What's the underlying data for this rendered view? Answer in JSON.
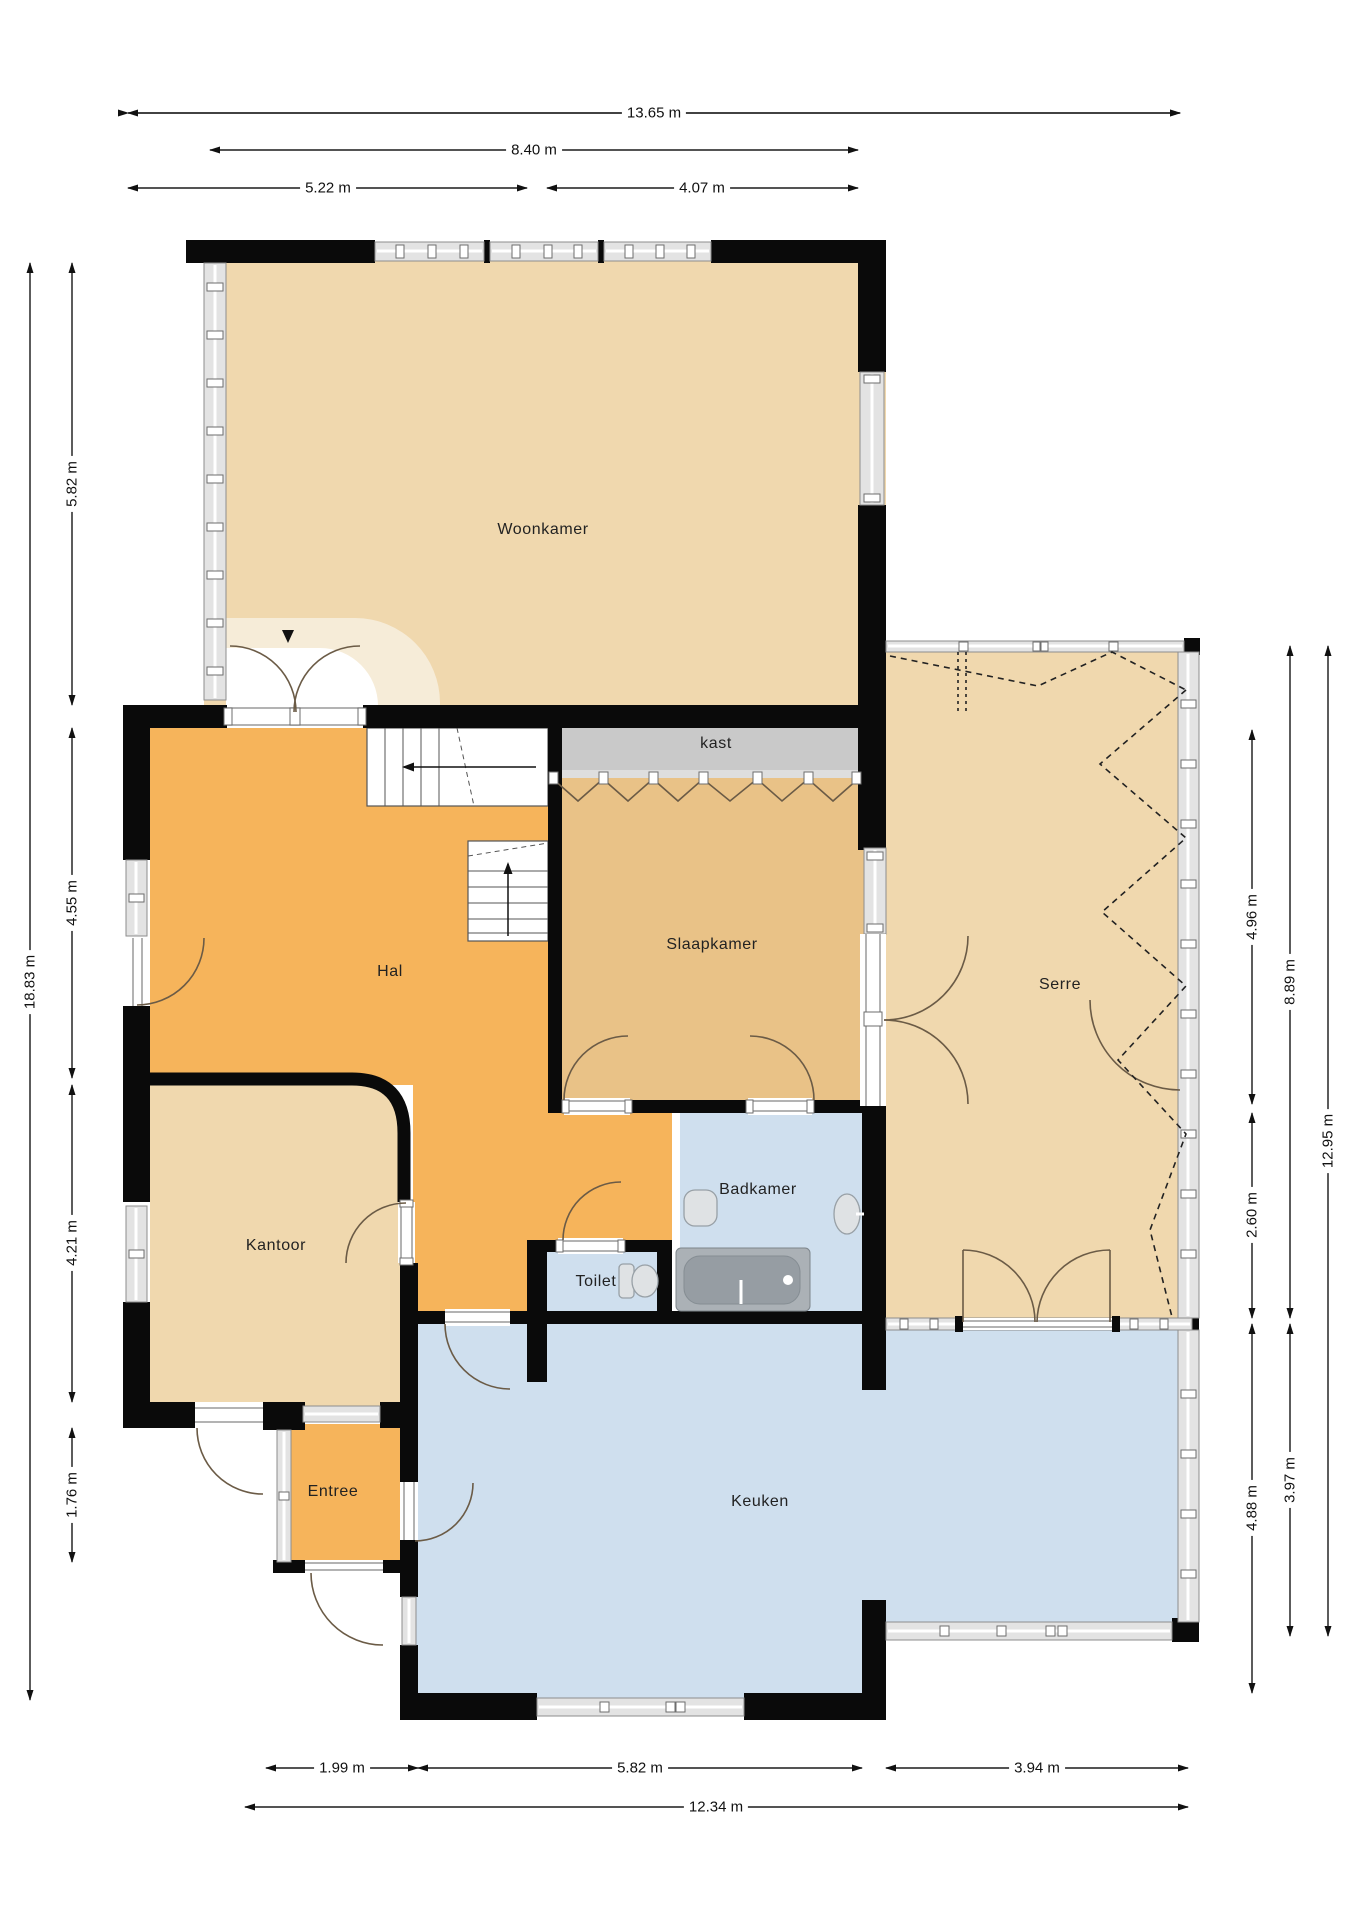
{
  "title": "Plattegrond begane grond",
  "rooms": {
    "woonkamer": {
      "label": "Woonkamer"
    },
    "hal": {
      "label": "Hal"
    },
    "kast": {
      "label": "kast"
    },
    "slaapkamer": {
      "label": "Slaapkamer"
    },
    "serre": {
      "label": "Serre"
    },
    "kantoor": {
      "label": "Kantoor"
    },
    "badkamer": {
      "label": "Badkamer"
    },
    "toilet": {
      "label": "Toilet"
    },
    "entree": {
      "label": "Entree"
    },
    "keuken": {
      "label": "Keuken"
    }
  },
  "dimensions": {
    "top": [
      {
        "value": "13.65 m"
      },
      {
        "value": "8.40 m"
      },
      {
        "value": "5.22 m"
      },
      {
        "value": "4.07 m"
      }
    ],
    "bottom": [
      {
        "value": "1.99 m"
      },
      {
        "value": "5.82 m"
      },
      {
        "value": "3.94 m"
      },
      {
        "value": "12.34 m"
      }
    ],
    "left": [
      {
        "value": "18.83 m"
      },
      {
        "value": "5.82 m"
      },
      {
        "value": "4.55 m"
      },
      {
        "value": "4.21 m"
      },
      {
        "value": "1.76 m"
      }
    ],
    "right": [
      {
        "value": "4.96 m"
      },
      {
        "value": "2.60 m"
      },
      {
        "value": "4.88 m"
      },
      {
        "value": "8.89 m"
      },
      {
        "value": "3.97 m"
      },
      {
        "value": "12.95 m"
      }
    ]
  },
  "colors": {
    "wall": "#0a0a0a",
    "living_floor": "#f0d8ae",
    "hall_floor": "#f6b45b",
    "bedroom_floor": "#e9c287",
    "wet_room_floor": "#cfdfee",
    "closet": "#c9c9c9"
  }
}
